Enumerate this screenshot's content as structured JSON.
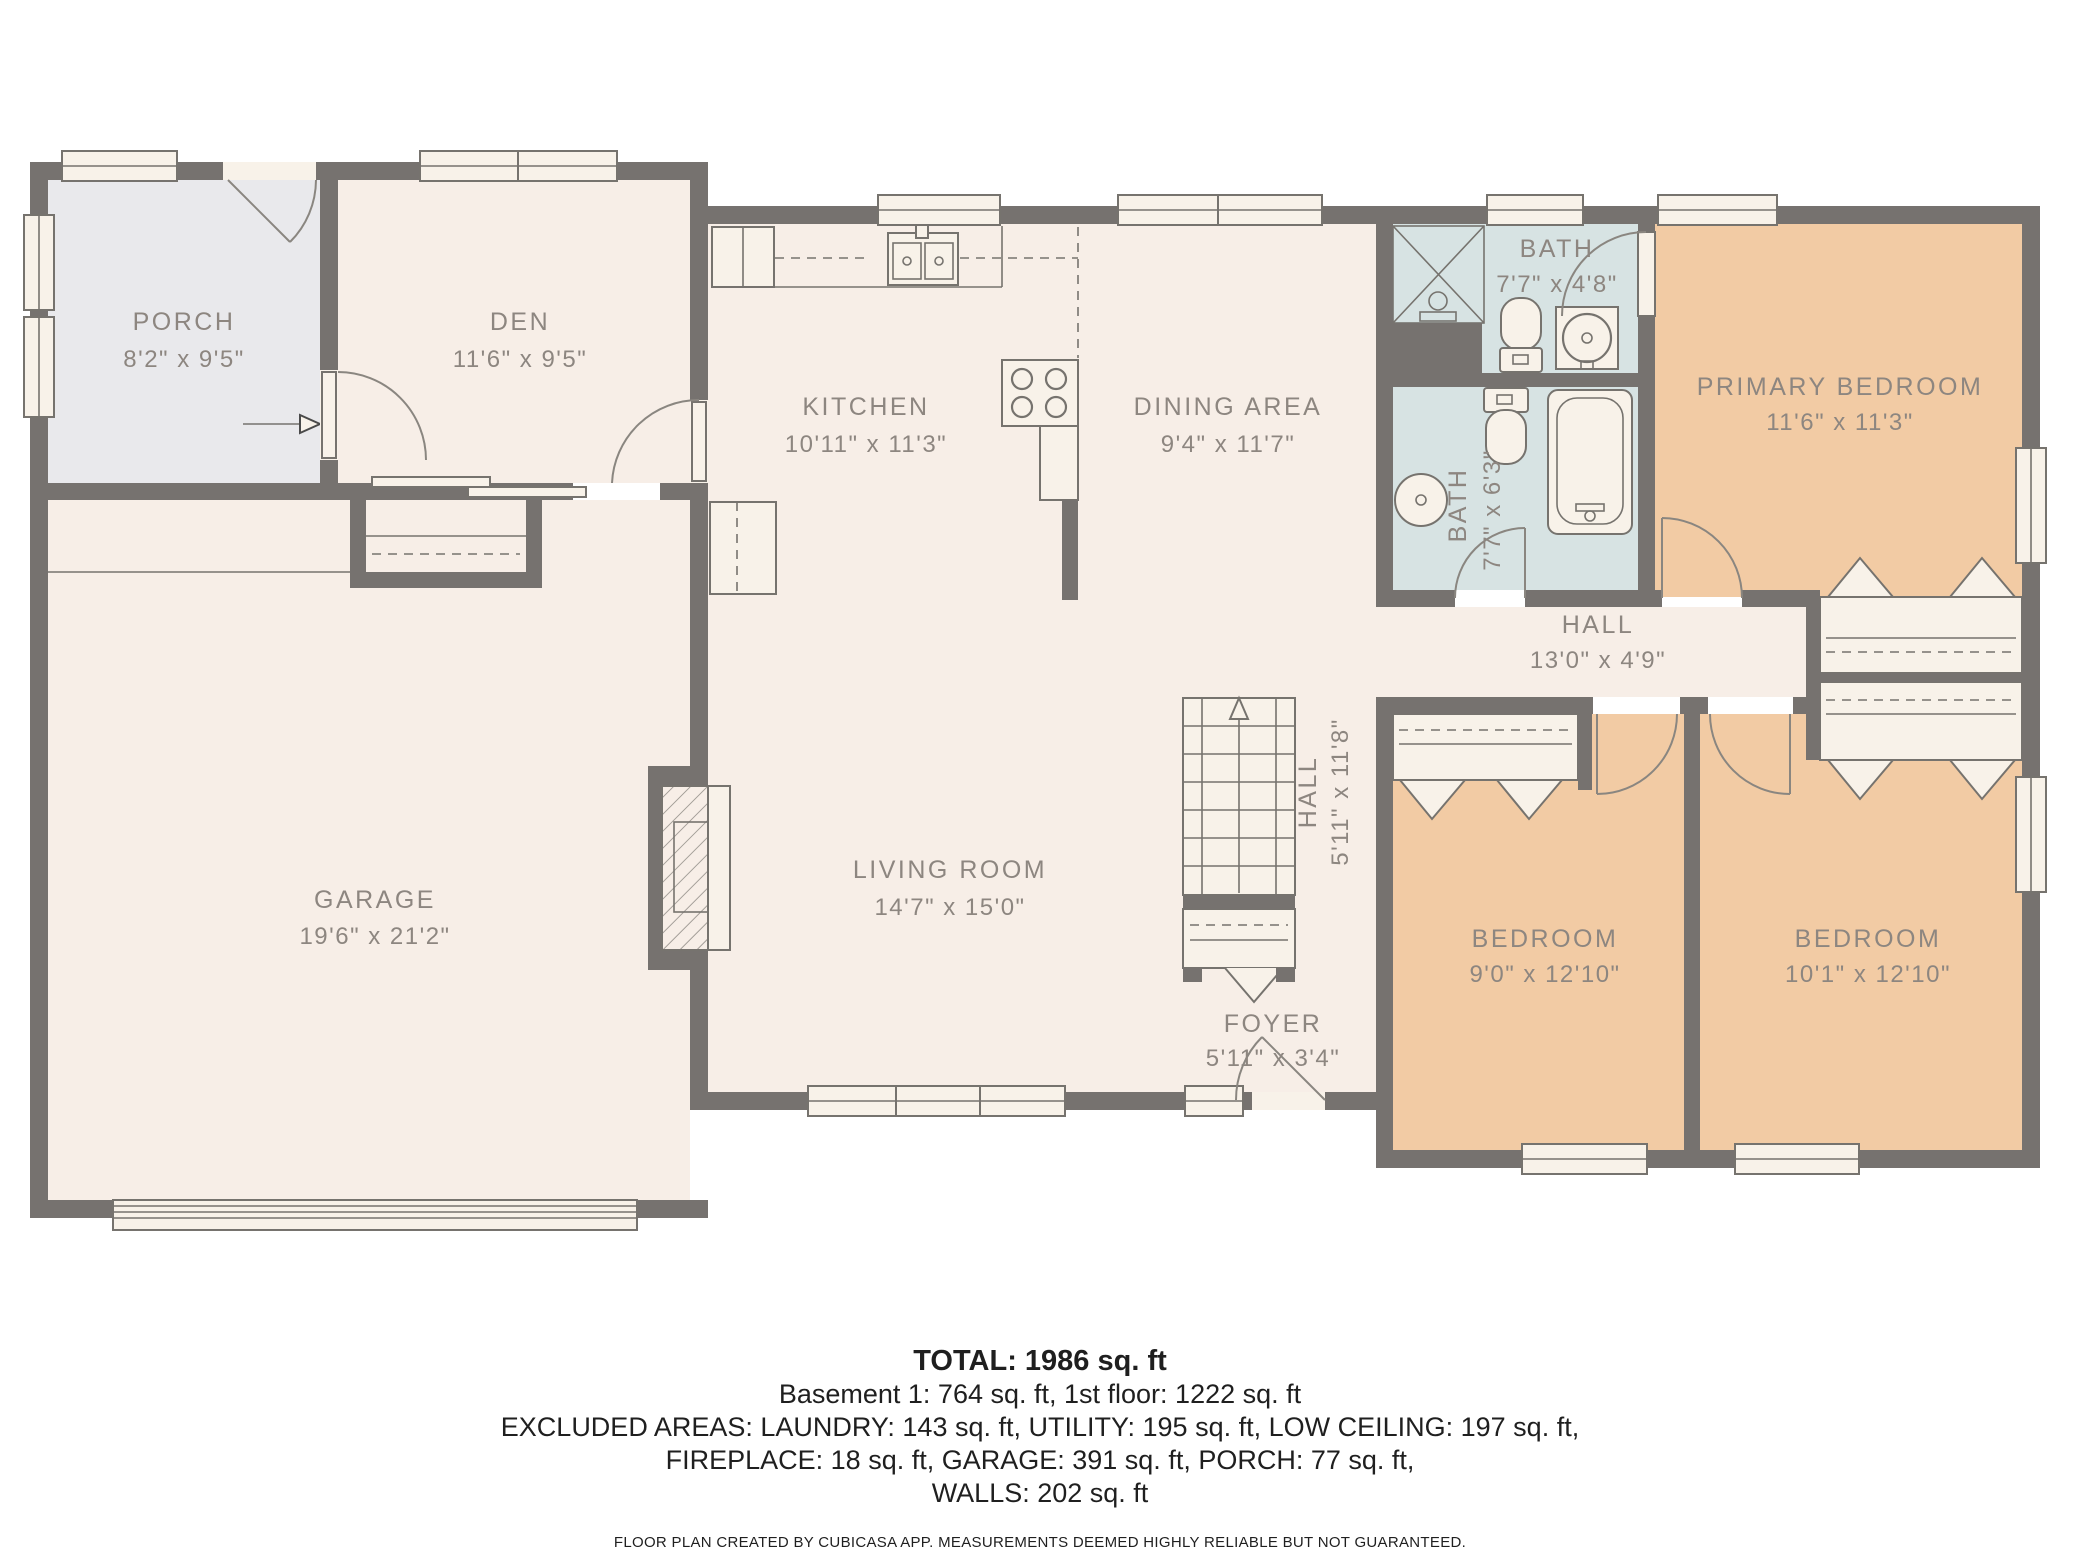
{
  "rooms": {
    "porch": {
      "name": "PORCH",
      "dims": "8'2\" x 9'5\""
    },
    "den": {
      "name": "DEN",
      "dims": "11'6\" x 9'5\""
    },
    "kitchen": {
      "name": "KITCHEN",
      "dims": "10'11\" x 11'3\""
    },
    "dining": {
      "name": "DINING AREA",
      "dims": "9'4\" x 11'7\""
    },
    "bath1": {
      "name": "BATH",
      "dims": "7'7\" x 4'8\""
    },
    "bath2": {
      "name": "BATH",
      "dims": "7'7\" x 6'3\""
    },
    "primary": {
      "name": "PRIMARY BEDROOM",
      "dims": "11'6\" x 11'3\""
    },
    "hall": {
      "name": "HALL",
      "dims": "13'0\" x 4'9\""
    },
    "stair_hall": {
      "name": "HALL",
      "dims": "5'11\" x 11'8\""
    },
    "living": {
      "name": "LIVING ROOM",
      "dims": "14'7\" x 15'0\""
    },
    "garage": {
      "name": "GARAGE",
      "dims": "19'6\" x 21'2\""
    },
    "foyer": {
      "name": "FOYER",
      "dims": "5'11\" x 3'4\""
    },
    "bedroom1": {
      "name": "BEDROOM",
      "dims": "9'0\" x 12'10\""
    },
    "bedroom2": {
      "name": "BEDROOM",
      "dims": "10'1\" x 12'10\""
    }
  },
  "footer": {
    "total": "TOTAL: 1986 sq. ft",
    "line1": "Basement 1: 764 sq. ft, 1st floor: 1222 sq. ft",
    "line2": "EXCLUDED AREAS: LAUNDRY: 143 sq. ft, UTILITY: 195 sq. ft, LOW CEILING: 197 sq. ft,",
    "line3": "FIREPLACE: 18 sq. ft, GARAGE: 391 sq. ft, PORCH: 77 sq. ft,",
    "line4": "WALLS: 202 sq. ft",
    "disclaimer": "FLOOR PLAN CREATED BY CUBICASA APP. MEASUREMENTS DEEMED HIGHLY RELIABLE BUT NOT GUARANTEED."
  },
  "colors": {
    "wall": "#76726F",
    "room_cream": "#F7EEE7",
    "porch_gray": "#E9E9EC",
    "bath_blue": "#D7E3E3",
    "bedroom_peach": "#F2CBA4",
    "fixture_white": "#F8F2E9",
    "line": "#76736E",
    "label_text": "#8D8680",
    "footer_text": "#1F1F1F"
  }
}
